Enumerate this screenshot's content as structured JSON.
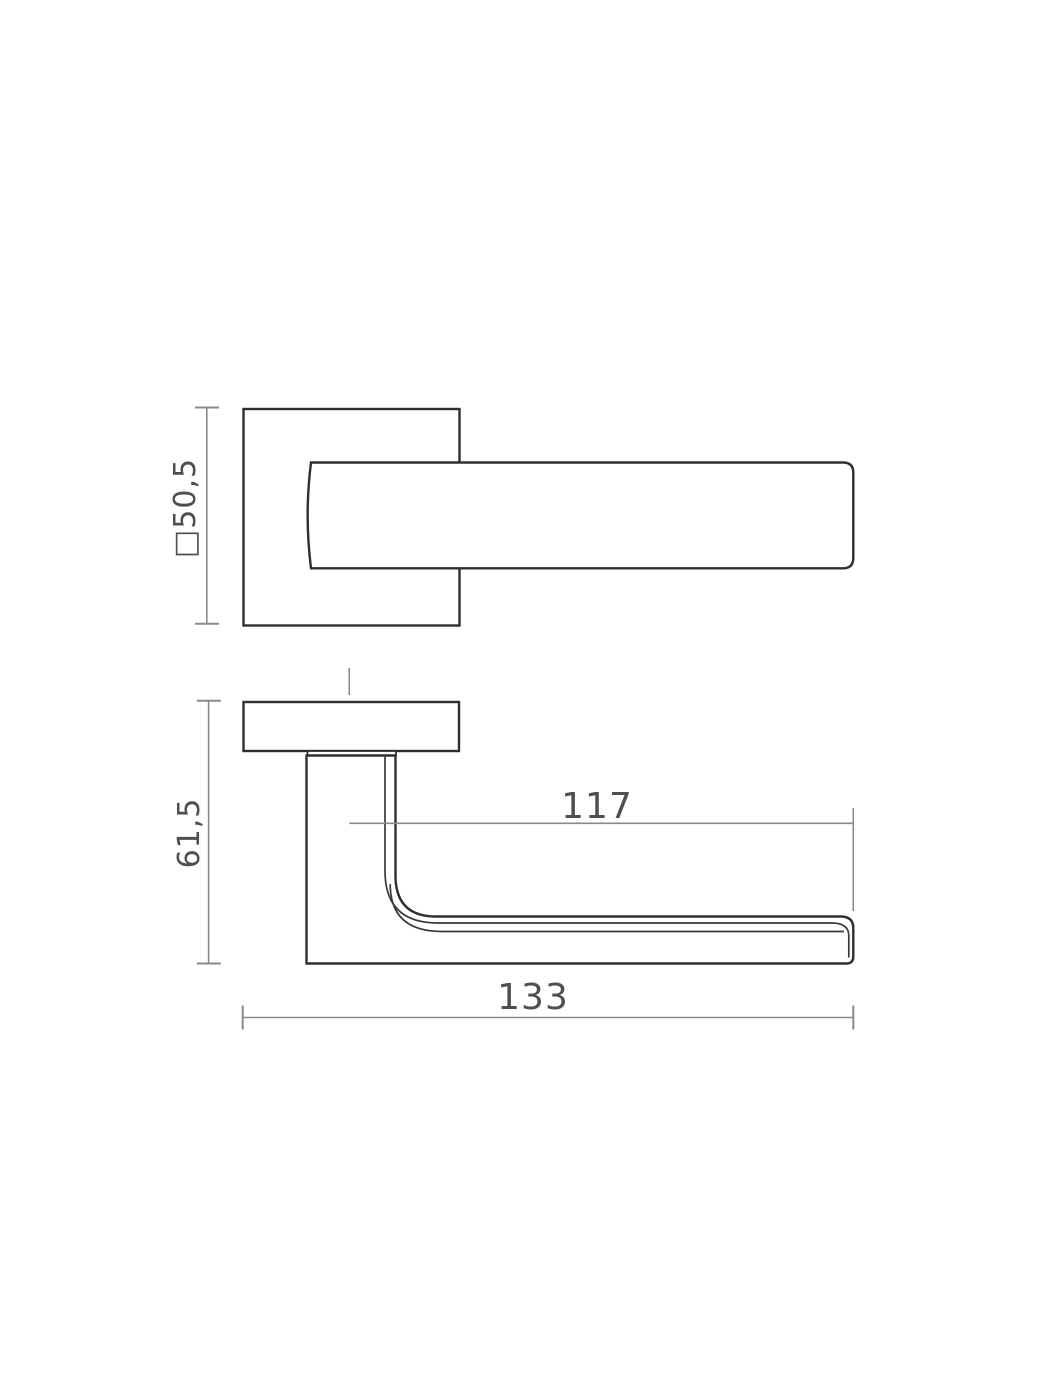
{
  "drawing": {
    "views": {
      "top_view": {
        "size_label": "□50,5"
      },
      "side_view": {
        "height_label": "61,5",
        "reach_label": "117",
        "length_label": "133"
      }
    },
    "colors": {
      "outline": "#2f2f2f",
      "contour_line": "#3a3a3a",
      "dimension_line": "#8a8a8a",
      "label_text": "#4f4f4f",
      "background": "#ffffff"
    }
  }
}
